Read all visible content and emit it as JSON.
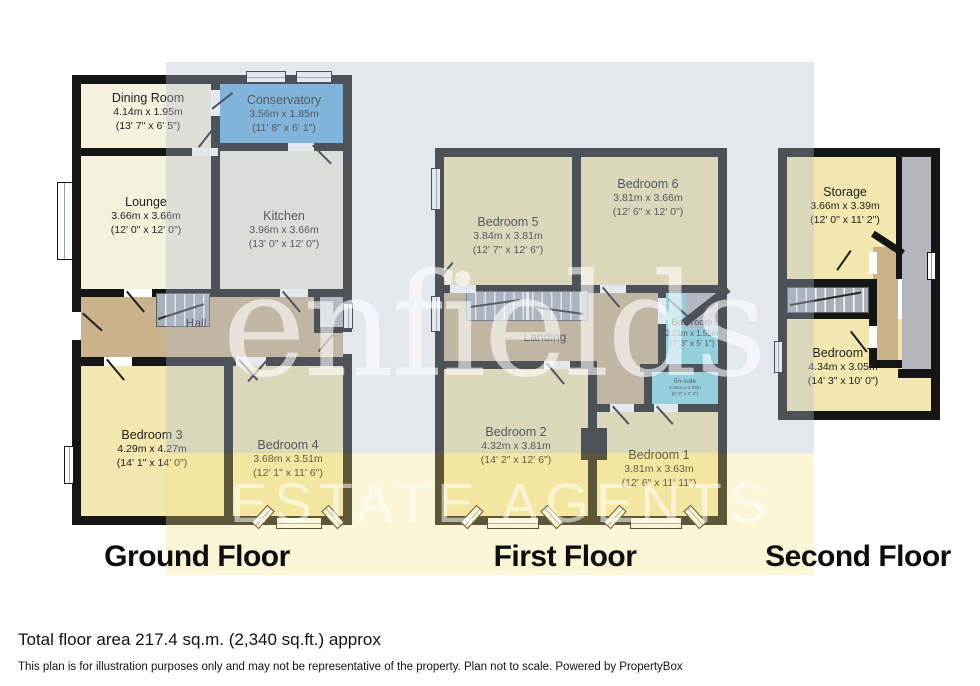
{
  "watermark": {
    "name": "enfields",
    "tagline": "ESTATE AGENTS"
  },
  "floors": {
    "ground": {
      "title": "Ground Floor",
      "rooms": {
        "dining": {
          "name": "Dining Room",
          "metric": "4.14m x 1.95m",
          "imperial": "(13' 7\" x 6' 5\")"
        },
        "conservatory": {
          "name": "Conservatory",
          "metric": "3.56m x 1.85m",
          "imperial": "(11' 8\" x 6' 1\")"
        },
        "lounge": {
          "name": "Lounge",
          "metric": "3.66m x 3.66m",
          "imperial": "(12' 0\" x 12' 0\")"
        },
        "kitchen": {
          "name": "Kitchen",
          "metric": "3.96m x 3.66m",
          "imperial": "(13' 0\" x 12' 0\")"
        },
        "hall": {
          "name": "Hall"
        },
        "bed3": {
          "name": "Bedroom 3",
          "metric": "4.29m x 4.27m",
          "imperial": "(14' 1\" x 14' 0\")"
        },
        "bed4": {
          "name": "Bedroom 4",
          "metric": "3.68m x 3.51m",
          "imperial": "(12' 1\" x 11' 6\")"
        }
      }
    },
    "first": {
      "title": "First Floor",
      "rooms": {
        "bed5": {
          "name": "Bedroom 5",
          "metric": "3.84m x 3.81m",
          "imperial": "(12' 7\" x 12' 6\")"
        },
        "bed6": {
          "name": "Bedroom 6",
          "metric": "3.81m x 3.66m",
          "imperial": "(12' 6\" x 12' 0\")"
        },
        "landing": {
          "name": "Landing"
        },
        "bathroom": {
          "name": "Bathroom",
          "metric": "2.21m x 1.55m",
          "imperial": "(7' 3\" x 5' 1\")"
        },
        "ensuite": {
          "name": "En-suite",
          "metric": "2.05m x 0.99m",
          "imperial": "(6' 9\" x 3' 3\")"
        },
        "bed2": {
          "name": "Bedroom 2",
          "metric": "4.32m x 3.81m",
          "imperial": "(14' 2\" x 12' 6\")"
        },
        "bed1": {
          "name": "Bedroom 1",
          "metric": "3.81m x 3.63m",
          "imperial": "(12' 6\" x 11' 11\")"
        }
      }
    },
    "second": {
      "title": "Second Floor",
      "rooms": {
        "storage": {
          "name": "Storage",
          "metric": "3.66m x 3.39m",
          "imperial": "(12' 0\" x 11' 2\")"
        },
        "bed7": {
          "name": "Bedroom 7",
          "metric": "4.34m x 3.05m",
          "imperial": "(14' 3\" x 10' 0\")"
        }
      }
    }
  },
  "footer": {
    "area": "Total floor area 217.4 sq.m. (2,340 sq.ft.) approx",
    "disclaimer": "This plan is for illustration purposes only and may not be representative of the property. Plan not to scale. Powered by PropertyBox"
  },
  "colors": {
    "wall": "#151515",
    "cream_room": "#f6f1dd",
    "yellow_room": "#f2e7ae",
    "conservatory_blue": "#66b0e0",
    "bathroom_cyan": "#86d9e3",
    "hall_tan": "#cab28a",
    "eaves_gray": "#b3b7bd",
    "background_panel_gray": "#e3e7ee",
    "background_panel_yellow": "#fbf6d7"
  }
}
